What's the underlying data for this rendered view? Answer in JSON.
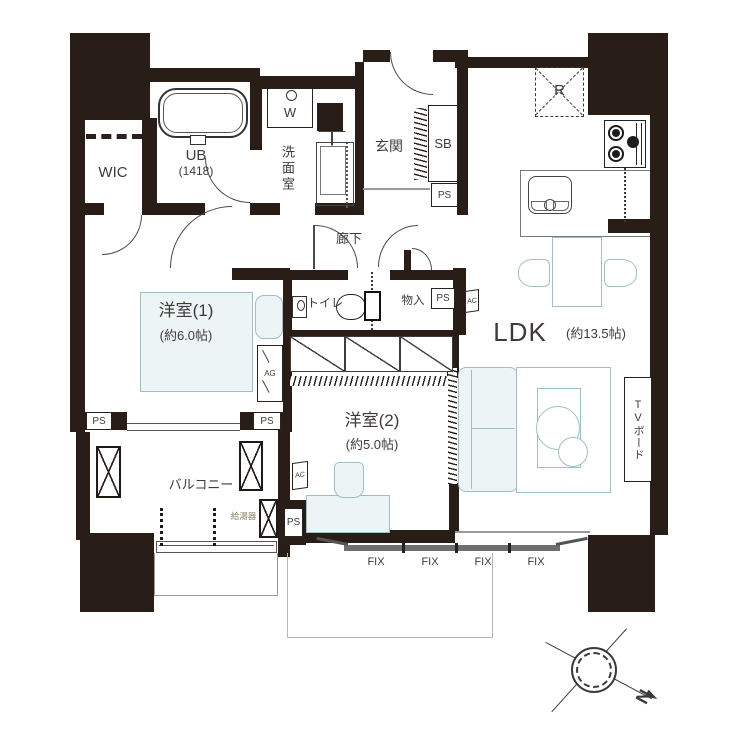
{
  "labels": {
    "wic": "WIC",
    "ub": "UB",
    "ub_size": "(1418)",
    "washroom": "洗面室",
    "entrance": "玄関",
    "shoe_box": "SB",
    "ps": "PS",
    "ac": "AC",
    "ag": "AG",
    "washer": "W",
    "fridge": "R",
    "corridor": "廊下",
    "toilet": "トイレ",
    "storage": "物入",
    "bedroom1": "洋室(1)",
    "bedroom1_size": "(約6.0帖)",
    "bedroom2": "洋室(2)",
    "bedroom2_size": "(約5.0帖)",
    "ldk": "LDK",
    "ldk_size": "(約13.5帖)",
    "balcony": "バルコニー",
    "water_heater": "給湯器",
    "tv_board": "TVボード",
    "north": "N",
    "fix_windows": [
      "FIX",
      "FIX",
      "FIX",
      "FIX"
    ]
  },
  "colors": {
    "wall": "#281d17",
    "furniture_line": "#9fbfc8",
    "furniture_fill": "#ecf4f6",
    "text": "#3f3a37",
    "fix_band": "#6e6e6e",
    "water_heater_text": "#8a8264"
  }
}
